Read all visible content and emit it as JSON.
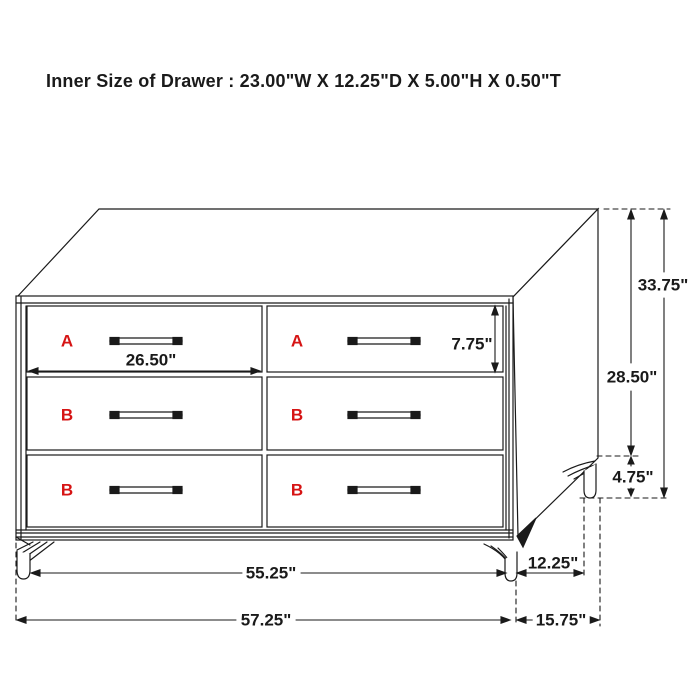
{
  "title": "Inner Size of Drawer : 23.00\"W X 12.25\"D X 5.00\"H X 0.50\"T",
  "diagram": {
    "drawer_labels": {
      "left_column": [
        "A",
        "B",
        "B"
      ],
      "right_column": [
        "A",
        "B",
        "B"
      ]
    },
    "dimensions": {
      "drawer_front_width": "26.50\"",
      "drawer_front_height": "7.75\"",
      "total_height": "33.75\"",
      "case_height": "28.50\"",
      "leg_height": "4.75\"",
      "front_width_between_legs": "55.25\"",
      "side_depth_between_legs": "12.25\"",
      "total_width": "57.25\"",
      "total_depth": "15.75\""
    },
    "colors": {
      "line": "#1a1a1a",
      "label_red": "#d61414",
      "background": "#ffffff"
    }
  }
}
